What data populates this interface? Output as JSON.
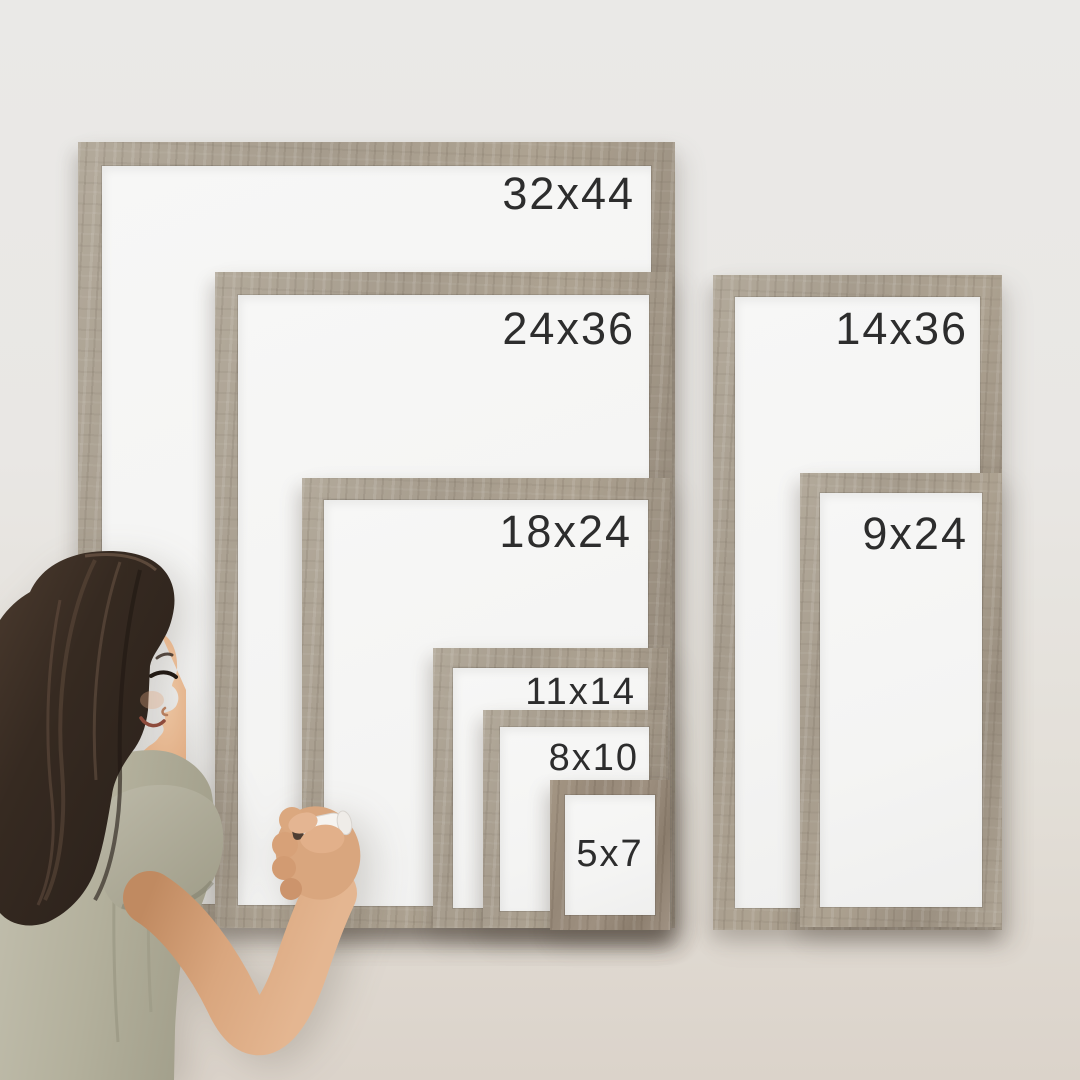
{
  "frames": [
    {
      "id": "f-32x44",
      "label": "32x44"
    },
    {
      "id": "f-24x36",
      "label": "24x36"
    },
    {
      "id": "f-18x24",
      "label": "18x24"
    },
    {
      "id": "f-11x14",
      "label": "11x14"
    },
    {
      "id": "f-8x10",
      "label": "8x10"
    },
    {
      "id": "f-5x7",
      "label": "5x7"
    },
    {
      "id": "f-14x36",
      "label": "14x36"
    },
    {
      "id": "f-9x24",
      "label": "9x24"
    }
  ],
  "palette": {
    "wall_top": "#eae9e7",
    "wall_bottom": "#dbd3ca",
    "frame_wood": "#a89d8e",
    "frame_wood_dark": "#9b8d7c",
    "whiteboard": "#f6f6f5",
    "label_text": "#2d2d2d",
    "hair": "#352a22",
    "shirt": "#b5b2a0",
    "skin": "#d9a67e",
    "marker_body": "#f6f4f1",
    "marker_tip": "#4e3e33"
  }
}
